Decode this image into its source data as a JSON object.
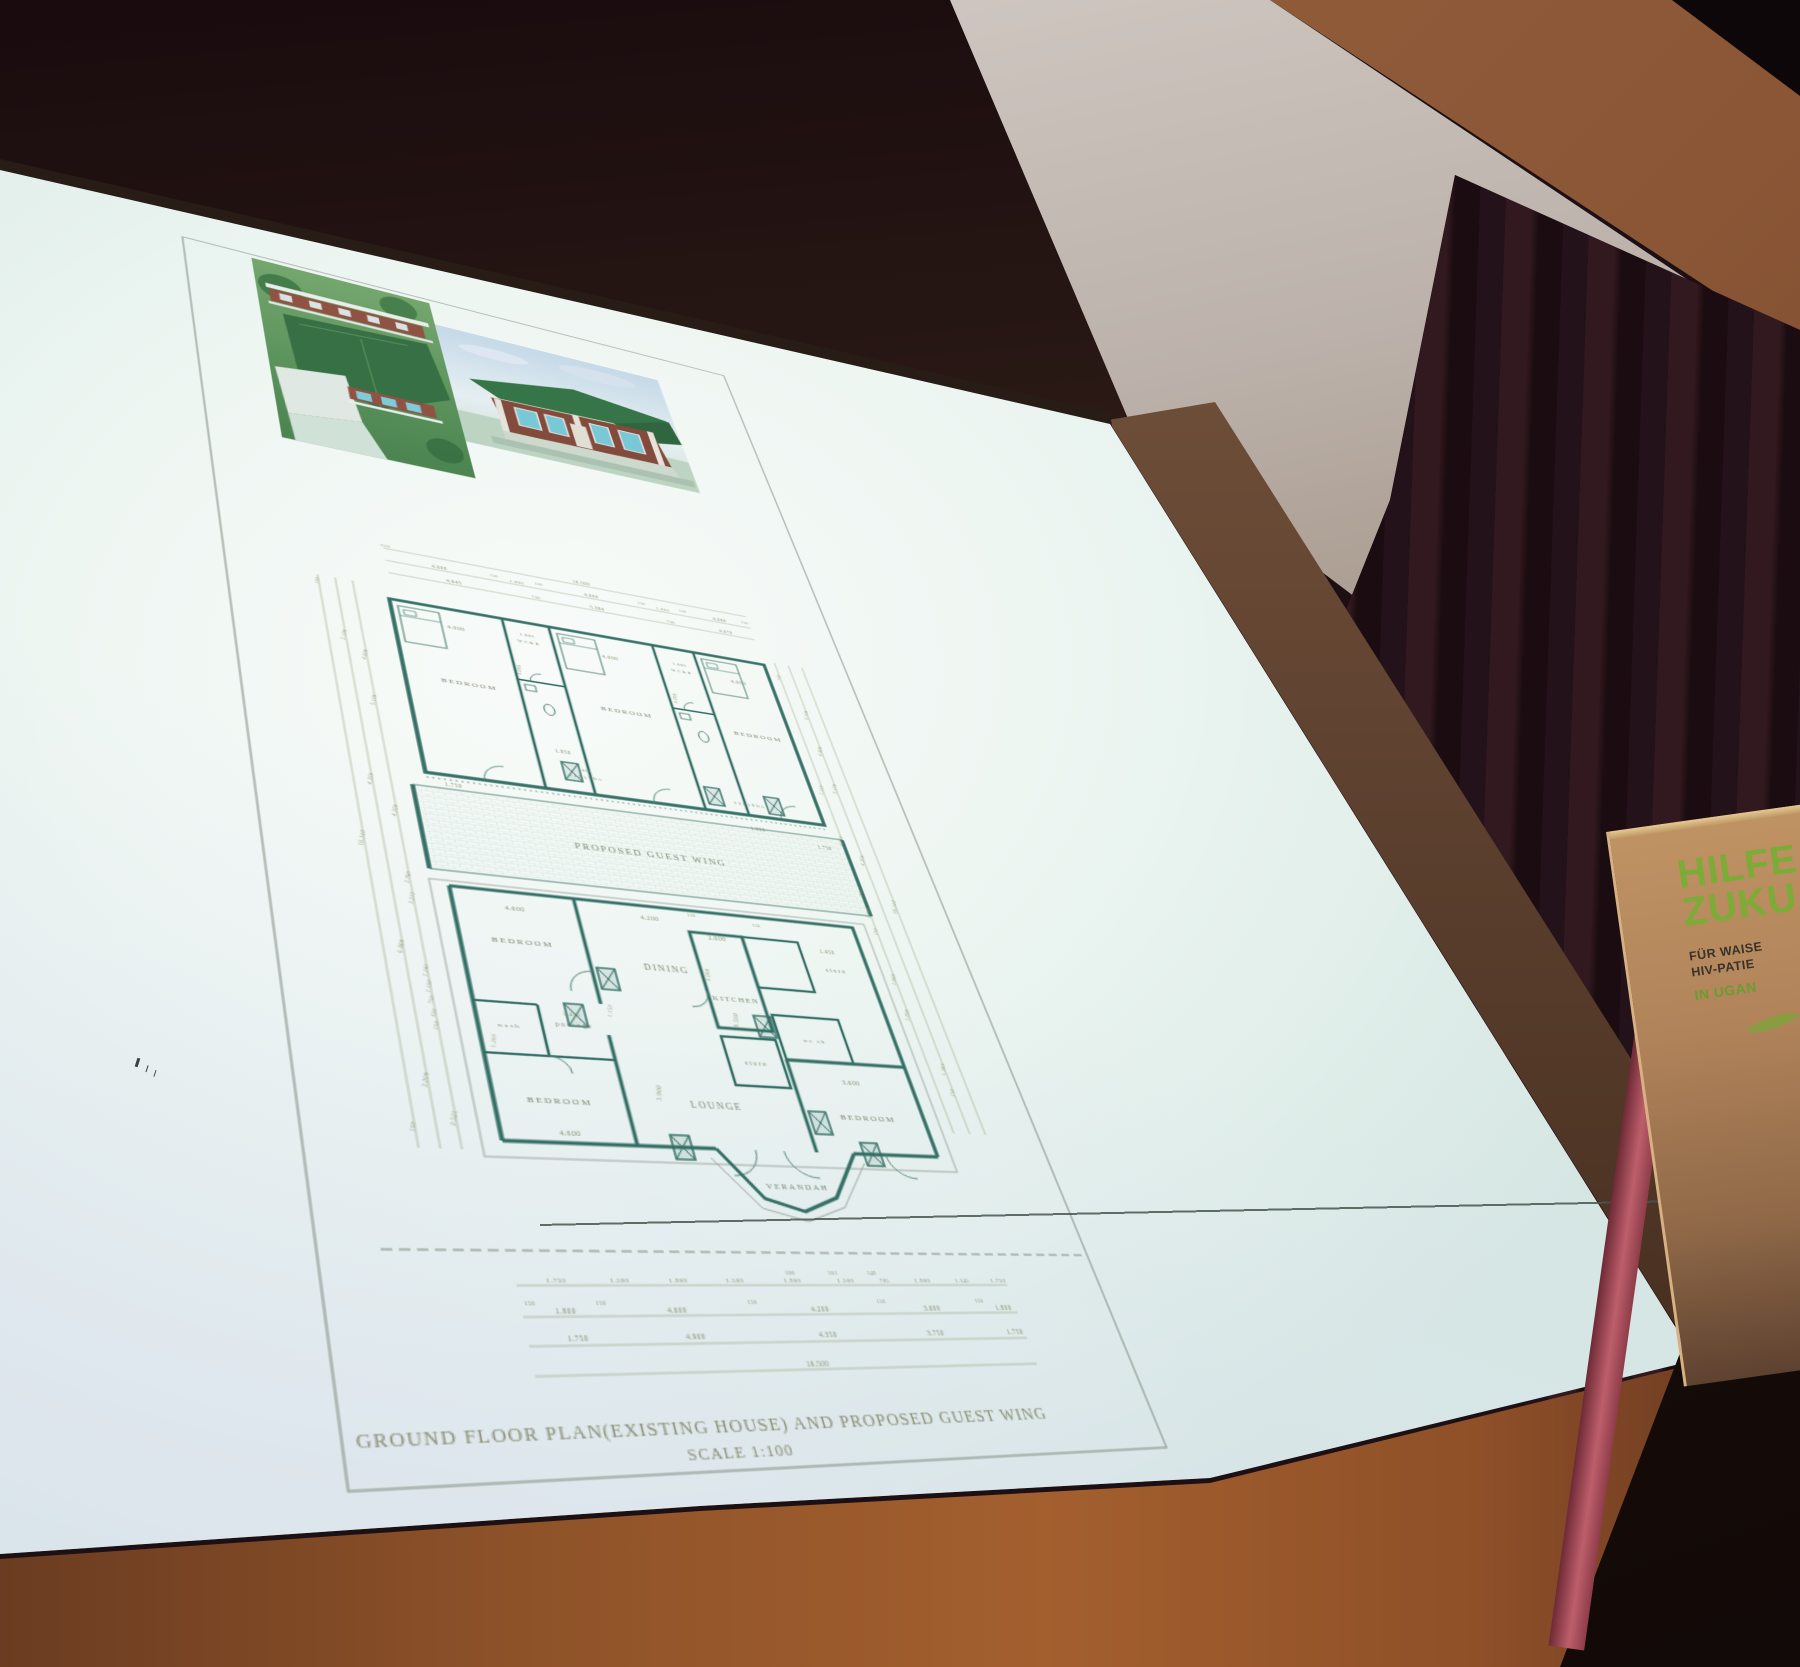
{
  "scene": {
    "setting": "conference hall with projector screen, dark red stage curtain, wooden floor",
    "colors": {
      "screen": "#eef6f2",
      "curtain": "#24121a",
      "floor": "#a35f2e",
      "banner_bg": "#b0835a",
      "banner_green": "#7cab38",
      "plan_wall_ink": "#2c6a5f",
      "plan_text_ink": "#85906f"
    },
    "banner": {
      "heading1": "HILFE",
      "heading2": "ZUKU",
      "sub1": "FÜR WAISE",
      "sub2": "HIV-PATIE",
      "location": "IN UGAN"
    }
  },
  "sheet": {
    "title_line1": "GROUND FLOOR PLAN(EXISTING HOUSE) AND PROPOSED GUEST WING",
    "title_line2": "SCALE 1:100",
    "rooms_upper_wing": [
      "BEDROOM",
      "WC&B",
      "BEDROOM",
      "WC&B",
      "BEDROOM",
      "VERANDA"
    ],
    "rooms_main_house": [
      "BEDROOM",
      "DINING",
      "KITCHEN",
      "store",
      "wash",
      "passage",
      "store",
      "wc sh",
      "LOUNGE",
      "BEDROOM",
      "BEDROOM",
      "VERANDAH"
    ],
    "labels": [
      {
        "t": "150",
        "x": 136,
        "y": 417,
        "s": 4.8
      },
      {
        "t": "16.500",
        "x": 310,
        "y": 417,
        "s": 5.2
      },
      {
        "t": "4.000",
        "x": 180,
        "y": 433,
        "s": 5.2
      },
      {
        "t": "150",
        "x": 228,
        "y": 430,
        "s": 4.2
      },
      {
        "t": "1.800",
        "x": 248,
        "y": 433,
        "s": 4.8
      },
      {
        "t": "150",
        "x": 268,
        "y": 430,
        "s": 4.2
      },
      {
        "t": "4.000",
        "x": 316,
        "y": 433,
        "s": 5.2
      },
      {
        "t": "150",
        "x": 364,
        "y": 430,
        "s": 4.2
      },
      {
        "t": "1.800",
        "x": 384,
        "y": 433,
        "s": 4.8
      },
      {
        "t": "150",
        "x": 404,
        "y": 430,
        "s": 4.2
      },
      {
        "t": "4.000",
        "x": 440,
        "y": 433,
        "s": 5.2
      },
      {
        "t": "150",
        "x": 466,
        "y": 430,
        "s": 4.2
      },
      {
        "t": "4.945",
        "x": 190,
        "y": 449,
        "s": 5.2
      },
      {
        "t": "750",
        "x": 262,
        "y": 449,
        "s": 4.6
      },
      {
        "t": "5.384",
        "x": 318,
        "y": 449,
        "s": 5.2
      },
      {
        "t": "750",
        "x": 388,
        "y": 449,
        "s": 4.6
      },
      {
        "t": "4.070",
        "x": 442,
        "y": 449,
        "s": 5.2
      },
      {
        "t": "4.000",
        "x": 182,
        "y": 510,
        "s": 5.8
      },
      {
        "t": "1.800",
        "x": 244,
        "y": 503,
        "s": 4.8
      },
      {
        "t": "WC&B",
        "x": 244,
        "y": 512,
        "s": 4.4,
        "k": "room"
      },
      {
        "t": "4.000",
        "x": 316,
        "y": 514,
        "s": 5.8
      },
      {
        "t": "1.800",
        "x": 382,
        "y": 507,
        "s": 4.8
      },
      {
        "t": "WC&B",
        "x": 382,
        "y": 516,
        "s": 4.4,
        "k": "room"
      },
      {
        "t": "4.000",
        "x": 436,
        "y": 518,
        "s": 5.8
      },
      {
        "t": "BEDROOM",
        "x": 182,
        "y": 578,
        "s": 7,
        "k": "room"
      },
      {
        "t": "BEDROOM",
        "x": 316,
        "y": 582,
        "s": 7,
        "k": "room"
      },
      {
        "t": "BEDROOM",
        "x": 436,
        "y": 587,
        "s": 7,
        "k": "room"
      },
      {
        "t": "4.800",
        "x": 230,
        "y": 548,
        "s": 4.8,
        "r": -80
      },
      {
        "t": "4.800",
        "x": 368,
        "y": 552,
        "s": 4.8,
        "r": -80
      },
      {
        "t": "1.950",
        "x": 248,
        "y": 642,
        "s": 5.2
      },
      {
        "t": "1.800",
        "x": 262,
        "y": 660,
        "s": 4
      },
      {
        "t": "VERANDA",
        "x": 262,
        "y": 668,
        "s": 3.6,
        "k": "room"
      },
      {
        "t": "VERANDA",
        "x": 404,
        "y": 674,
        "s": 3.6,
        "k": "room"
      },
      {
        "t": "1.750",
        "x": 150,
        "y": 697,
        "s": 5.2
      },
      {
        "t": "1.800",
        "x": 404,
        "y": 702,
        "s": 5.2
      },
      {
        "t": "PROPOSED GUEST WING",
        "x": 300,
        "y": 747,
        "s": 8.4,
        "k": "room"
      },
      {
        "t": "1.750",
        "x": 462,
        "y": 714,
        "s": 5.2
      },
      {
        "t": "4.600",
        "x": 176,
        "y": 818,
        "s": 5.8
      },
      {
        "t": "BEDROOM",
        "x": 176,
        "y": 850,
        "s": 7,
        "k": "room"
      },
      {
        "t": "4.200",
        "x": 282,
        "y": 814,
        "s": 5.8
      },
      {
        "t": "DINING",
        "x": 284,
        "y": 864,
        "s": 7.4,
        "k": "room"
      },
      {
        "t": "150",
        "x": 318,
        "y": 806,
        "s": 4
      },
      {
        "t": "150",
        "x": 372,
        "y": 810,
        "s": 4
      },
      {
        "t": "2.000",
        "x": 334,
        "y": 828,
        "s": 5.8
      },
      {
        "t": "1.450",
        "x": 428,
        "y": 831,
        "s": 5.2
      },
      {
        "t": "store",
        "x": 430,
        "y": 850,
        "s": 5.4,
        "k": "room"
      },
      {
        "t": "3.000",
        "x": 318,
        "y": 864,
        "s": 4.8,
        "r": -80
      },
      {
        "t": "KITCHEN",
        "x": 334,
        "y": 888,
        "s": 6.2,
        "k": "room"
      },
      {
        "t": "wash",
        "x": 152,
        "y": 927,
        "s": 5,
        "k": "room"
      },
      {
        "t": "1.200",
        "x": 140,
        "y": 940,
        "s": 4.4,
        "r": -75
      },
      {
        "t": "2.450",
        "x": 200,
        "y": 913,
        "s": 4.8
      },
      {
        "t": "passage",
        "x": 200,
        "y": 923,
        "s": 5.4,
        "k": "room"
      },
      {
        "t": "1.150",
        "x": 231,
        "y": 906,
        "s": 4.4,
        "r": -75
      },
      {
        "t": "store",
        "x": 334,
        "y": 947,
        "s": 5.4,
        "k": "room"
      },
      {
        "t": "wc sh",
        "x": 389,
        "y": 922,
        "s": 4.8,
        "k": "room"
      },
      {
        "t": "LOUNGE",
        "x": 292,
        "y": 988,
        "s": 7.4,
        "k": "room"
      },
      {
        "t": "8.560",
        "x": 330,
        "y": 906,
        "s": 5.2,
        "r": -78
      },
      {
        "t": "3.900",
        "x": 252,
        "y": 977,
        "s": 5.2,
        "r": -78
      },
      {
        "t": "3.600",
        "x": 408,
        "y": 960,
        "s": 5.8
      },
      {
        "t": "BEDROOM",
        "x": 412,
        "y": 992,
        "s": 7,
        "k": "room"
      },
      {
        "t": "BEDROOM",
        "x": 176,
        "y": 990,
        "s": 7,
        "k": "room"
      },
      {
        "t": "4.600",
        "x": 178,
        "y": 1016,
        "s": 5.8
      },
      {
        "t": "VERANDAH",
        "x": 336,
        "y": 1054,
        "s": 6.4,
        "k": "room"
      },
      {
        "t": "150",
        "x": 74,
        "y": 478,
        "s": 4.4,
        "r": -75
      },
      {
        "t": "16.310",
        "x": 74,
        "y": 762,
        "s": 5,
        "r": -75
      },
      {
        "t": "150",
        "x": 74,
        "y": 1014,
        "s": 4.4,
        "r": -75
      },
      {
        "t": "5.100",
        "x": 88,
        "y": 540,
        "s": 4.8,
        "r": -75
      },
      {
        "t": "4.350",
        "x": 88,
        "y": 700,
        "s": 4.8,
        "r": -75
      },
      {
        "t": "6.860",
        "x": 88,
        "y": 862,
        "s": 4.8,
        "r": -75
      },
      {
        "t": "3.000",
        "x": 88,
        "y": 976,
        "s": 4.8,
        "r": -75
      },
      {
        "t": "4.600",
        "x": 102,
        "y": 560,
        "s": 4.8,
        "r": -75
      },
      {
        "t": "5.100",
        "x": 102,
        "y": 612,
        "s": 4.8,
        "r": -75
      },
      {
        "t": "4.350",
        "x": 102,
        "y": 730,
        "s": 4.8,
        "r": -75
      },
      {
        "t": "2.760",
        "x": 102,
        "y": 796,
        "s": 4.4,
        "r": -75
      },
      {
        "t": "3.212",
        "x": 102,
        "y": 816,
        "s": 4.4,
        "r": -75
      },
      {
        "t": "1.200",
        "x": 102,
        "y": 882,
        "s": 4.2,
        "r": -75
      },
      {
        "t": "1.150",
        "x": 102,
        "y": 896,
        "s": 4.2,
        "r": -75
      },
      {
        "t": "750",
        "x": 102,
        "y": 908,
        "s": 4.2,
        "r": -75
      },
      {
        "t": "626",
        "x": 102,
        "y": 919,
        "s": 4.2,
        "r": -75
      },
      {
        "t": "150",
        "x": 102,
        "y": 930,
        "s": 4.2,
        "r": -75
      },
      {
        "t": "3.522",
        "x": 102,
        "y": 1006,
        "s": 4.8,
        "r": -75
      },
      {
        "t": "150",
        "x": 482,
        "y": 500,
        "s": 4.4,
        "r": -75
      },
      {
        "t": "2.518",
        "x": 482,
        "y": 642,
        "s": 4.6,
        "r": -75
      },
      {
        "t": "4.350",
        "x": 482,
        "y": 702,
        "s": 4.6,
        "r": -75
      },
      {
        "t": "900",
        "x": 482,
        "y": 760,
        "s": 4.2,
        "r": -75
      },
      {
        "t": "1.900",
        "x": 482,
        "y": 782,
        "s": 4.4,
        "r": -75
      },
      {
        "t": "150",
        "x": 482,
        "y": 802,
        "s": 4.2,
        "r": -75
      },
      {
        "t": "3.600",
        "x": 482,
        "y": 852,
        "s": 4.6,
        "r": -75
      },
      {
        "t": "3.090",
        "x": 482,
        "y": 888,
        "s": 4.6,
        "r": -75
      },
      {
        "t": "5.100",
        "x": 496,
        "y": 546,
        "s": 4.8,
        "r": -75
      },
      {
        "t": "4.800",
        "x": 496,
        "y": 592,
        "s": 4.8,
        "r": -75
      },
      {
        "t": "5.100",
        "x": 496,
        "y": 638,
        "s": 4.8,
        "r": -75
      },
      {
        "t": "4.350",
        "x": 496,
        "y": 722,
        "s": 4.8,
        "r": -75
      },
      {
        "t": "1.383",
        "x": 496,
        "y": 940,
        "s": 4.4,
        "r": -75
      },
      {
        "t": "150",
        "x": 496,
        "y": 962,
        "s": 4.2,
        "r": -75
      },
      {
        "t": "16.310",
        "x": 510,
        "y": 772,
        "s": 5,
        "r": -75
      },
      {
        "t": "300",
        "x": 310,
        "y": 1122,
        "s": 4
      },
      {
        "t": "301",
        "x": 342,
        "y": 1122,
        "s": 4
      },
      {
        "t": "349",
        "x": 372,
        "y": 1122,
        "s": 4
      },
      {
        "t": "1.750",
        "x": 146,
        "y": 1128,
        "s": 4.8
      },
      {
        "t": "1.500",
        "x": 188,
        "y": 1128,
        "s": 4.8
      },
      {
        "t": "1.900",
        "x": 228,
        "y": 1128,
        "s": 4.8
      },
      {
        "t": "1.500",
        "x": 268,
        "y": 1128,
        "s": 4.8
      },
      {
        "t": "1.900",
        "x": 310,
        "y": 1128,
        "s": 4.8
      },
      {
        "t": "1.500",
        "x": 350,
        "y": 1128,
        "s": 4.8
      },
      {
        "t": "705",
        "x": 380,
        "y": 1128,
        "s": 4.4
      },
      {
        "t": "1.900",
        "x": 410,
        "y": 1128,
        "s": 4.8
      },
      {
        "t": "1.145",
        "x": 442,
        "y": 1128,
        "s": 4.4
      },
      {
        "t": "1.750",
        "x": 472,
        "y": 1128,
        "s": 4.8
      },
      {
        "t": "150",
        "x": 126,
        "y": 1144,
        "s": 4
      },
      {
        "t": "150",
        "x": 172,
        "y": 1144,
        "s": 4
      },
      {
        "t": "150",
        "x": 276,
        "y": 1144,
        "s": 4
      },
      {
        "t": "150",
        "x": 372,
        "y": 1144,
        "s": 4
      },
      {
        "t": "150",
        "x": 450,
        "y": 1144,
        "s": 4
      },
      {
        "t": "1.800",
        "x": 148,
        "y": 1150,
        "s": 5.2
      },
      {
        "t": "4.600",
        "x": 222,
        "y": 1150,
        "s": 5.2
      },
      {
        "t": "4.200",
        "x": 324,
        "y": 1150,
        "s": 5.2
      },
      {
        "t": "3.600",
        "x": 410,
        "y": 1150,
        "s": 5.2
      },
      {
        "t": "1.800",
        "x": 468,
        "y": 1150,
        "s": 5.2
      },
      {
        "t": "1.750",
        "x": 152,
        "y": 1169,
        "s": 5.2
      },
      {
        "t": "4.900",
        "x": 230,
        "y": 1169,
        "s": 5.2
      },
      {
        "t": "4.350",
        "x": 324,
        "y": 1169,
        "s": 5.2
      },
      {
        "t": "3.750",
        "x": 406,
        "y": 1169,
        "s": 5.2
      },
      {
        "t": "1.750",
        "x": 470,
        "y": 1169,
        "s": 5.2
      },
      {
        "t": "16.500",
        "x": 310,
        "y": 1190,
        "s": 5.2
      },
      {
        "t": "GROUND FLOOR PLAN(EXISTING HOUSE) AND PROPOSED GUEST WING",
        "x": 240,
        "y": 1233,
        "s": 12,
        "k": "title"
      },
      {
        "t": "SCALE 1:100",
        "x": 240,
        "y": 1250,
        "s": 10.5,
        "k": "title"
      }
    ]
  }
}
